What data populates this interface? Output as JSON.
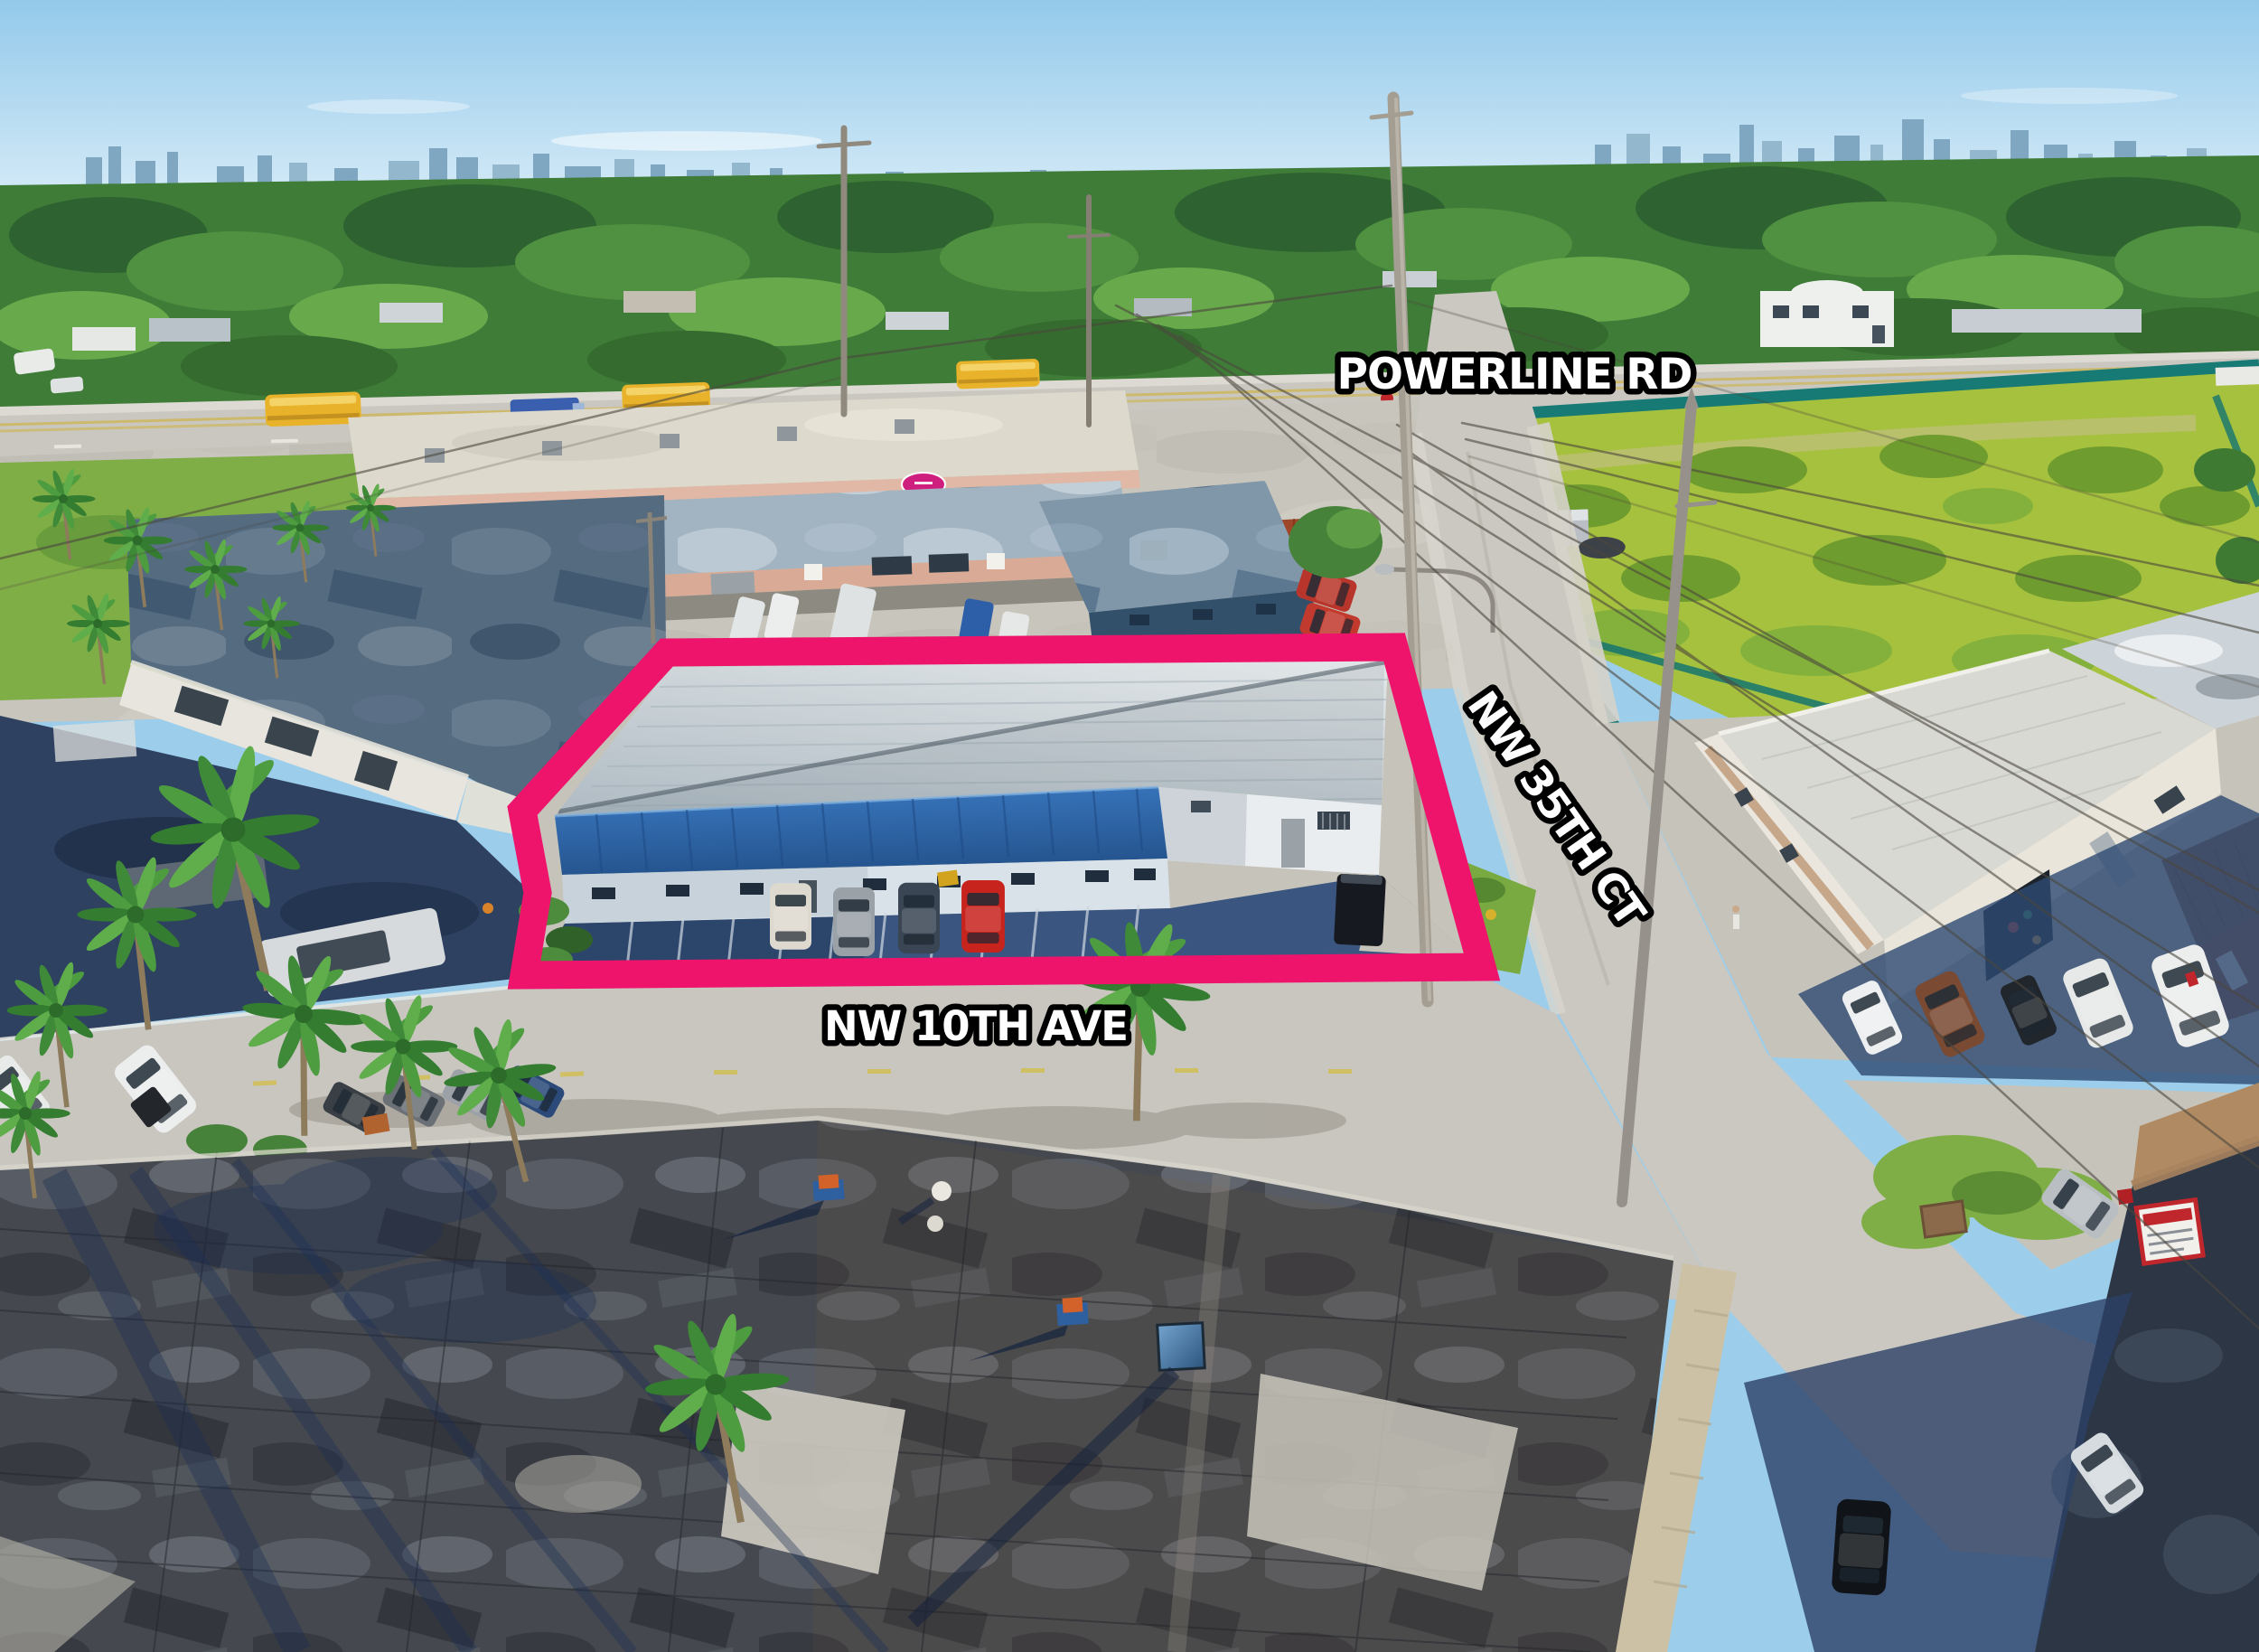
{
  "scene": {
    "type": "aerial-drone-photograph",
    "subject": "industrial warehouse parcel outlined in pink at the corner of NW 10th Ave and NW 35th Ct beside Powerline Rd"
  },
  "street_labels": {
    "powerline_rd": "POWERLINE RD",
    "nw_35th_ct": "NW 35TH CT",
    "nw_10th_ave": "NW 10TH AVE"
  },
  "colors": {
    "property_outline": "#ee146b",
    "label_fill": "#ffffff",
    "label_stroke": "#000000",
    "sky": "#9ccdeb",
    "foliage": "#4f9140",
    "road": "#c9c7c0",
    "subject_roof": "#ccd4d8",
    "subject_front_roof": "#2e6ab0",
    "construction_fence": "#177a74",
    "school_bus": "#e8b32a"
  }
}
